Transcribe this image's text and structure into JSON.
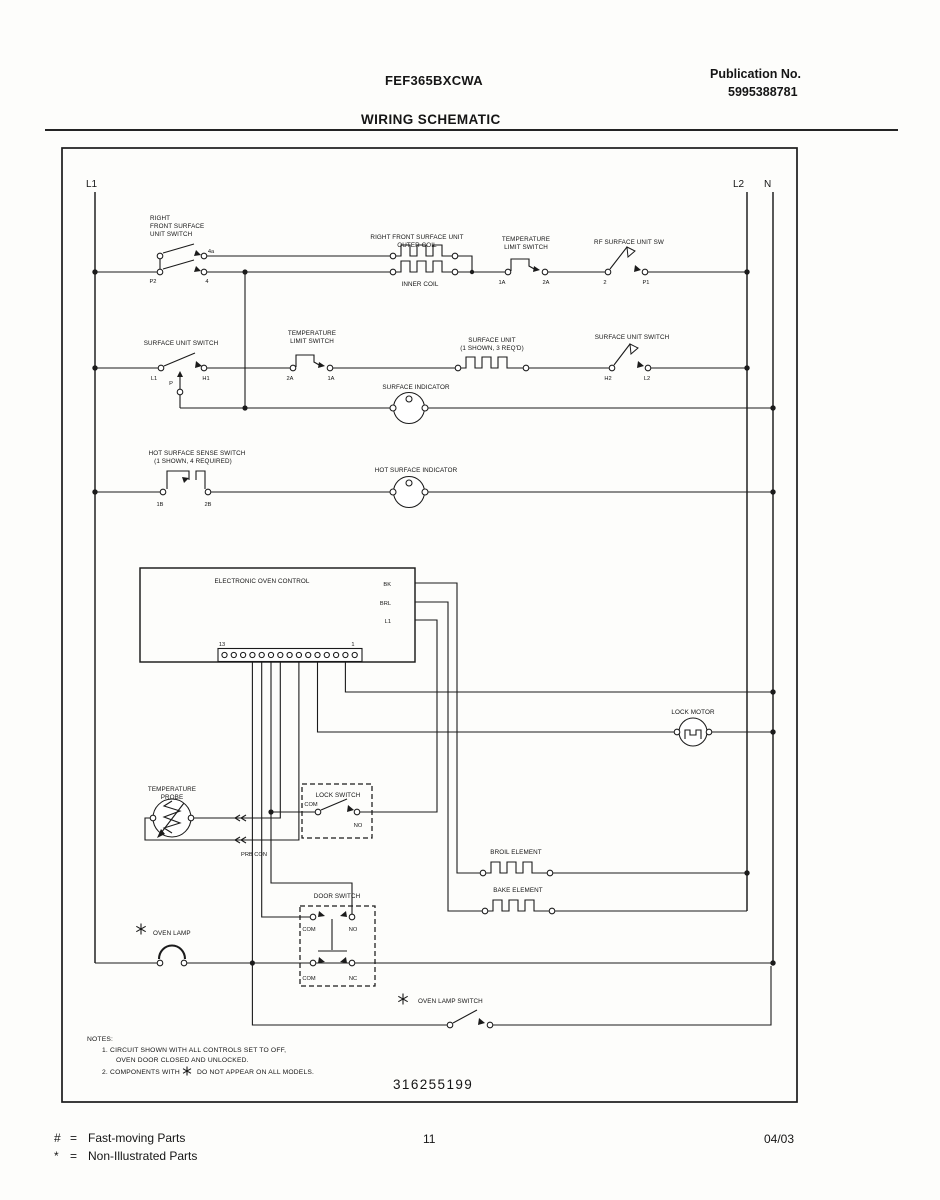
{
  "header": {
    "model": "FEF365BXCWA",
    "publication_label": "Publication No.",
    "publication_number": "5995388781",
    "title": "WIRING SCHEMATIC"
  },
  "rails": {
    "l1": "L1",
    "l2": "L2",
    "n": "N"
  },
  "row1": {
    "switch_name": [
      "RIGHT",
      "FRONT SURFACE",
      "UNIT SWITCH"
    ],
    "switch_terminals": [
      "P2",
      "4a",
      "4"
    ],
    "coil_name": [
      "RIGHT FRONT SURFACE UNIT",
      "OUTER COIL"
    ],
    "inner_coil": "INNER COIL",
    "limit_switch": [
      "TEMPERATURE",
      "LIMIT SWITCH"
    ],
    "limit_terminals": [
      "1A",
      "2A"
    ],
    "rf_switch": "RF SURFACE UNIT SW",
    "rf_terminals": [
      "2",
      "P1"
    ]
  },
  "row2": {
    "switch_name": "SURFACE UNIT SWITCH",
    "switch_terminals": [
      "L1",
      "P",
      "H1"
    ],
    "limit_switch": [
      "TEMPERATURE",
      "LIMIT SWITCH"
    ],
    "limit_terminals": [
      "2A",
      "1A"
    ],
    "unit_name": [
      "SURFACE UNIT",
      "(1 SHOWN, 3 REQ'D)"
    ],
    "right_switch": "SURFACE UNIT SWITCH",
    "right_terminals": [
      "H2",
      "L2"
    ],
    "indicator": "SURFACE INDICATOR"
  },
  "row3": {
    "switch_name": [
      "HOT SURFACE SENSE SWITCH",
      "(1 SHOWN, 4 REQUIRED)"
    ],
    "terminals": [
      "1B",
      "2B"
    ],
    "indicator": "HOT SURFACE INDICATOR"
  },
  "eoc": {
    "title": "ELECTRONIC OVEN CONTROL",
    "wire_labels": [
      "BK",
      "BRL",
      "L1"
    ],
    "pin_left": "13",
    "pin_right": "1"
  },
  "lock_motor": {
    "name": "LOCK MOTOR"
  },
  "probe": {
    "name": [
      "TEMPERATURE",
      "PROBE"
    ],
    "connector": "PRB CON"
  },
  "lock_switch": {
    "name": "LOCK SWITCH",
    "com": "COM",
    "no": "NO"
  },
  "elements": {
    "broil": "BROIL ELEMENT",
    "bake": "BAKE ELEMENT"
  },
  "door_switch": {
    "name": "DOOR SWITCH",
    "top": [
      "COM",
      "NO"
    ],
    "bottom": [
      "COM",
      "NC"
    ]
  },
  "oven_lamp": {
    "name": "OVEN LAMP"
  },
  "oven_lamp_switch": {
    "name": "OVEN LAMP SWITCH"
  },
  "notes": {
    "heading": "NOTES:",
    "line1": "1.   CIRCUIT SHOWN WITH ALL CONTROLS SET TO OFF,",
    "line2": "OVEN DOOR CLOSED AND UNLOCKED.",
    "line3_pre": "2.   COMPONENTS WITH",
    "line3_post": "DO NOT APPEAR ON ALL MODELS."
  },
  "part_number": "316255199",
  "footer": {
    "fast_symbol": "#",
    "fast_eq": "=",
    "fast_text": "Fast-moving Parts",
    "non_symbol": "*",
    "non_eq": "=",
    "non_text": "Non-Illustrated Parts",
    "page": "11",
    "date": "04/03"
  }
}
